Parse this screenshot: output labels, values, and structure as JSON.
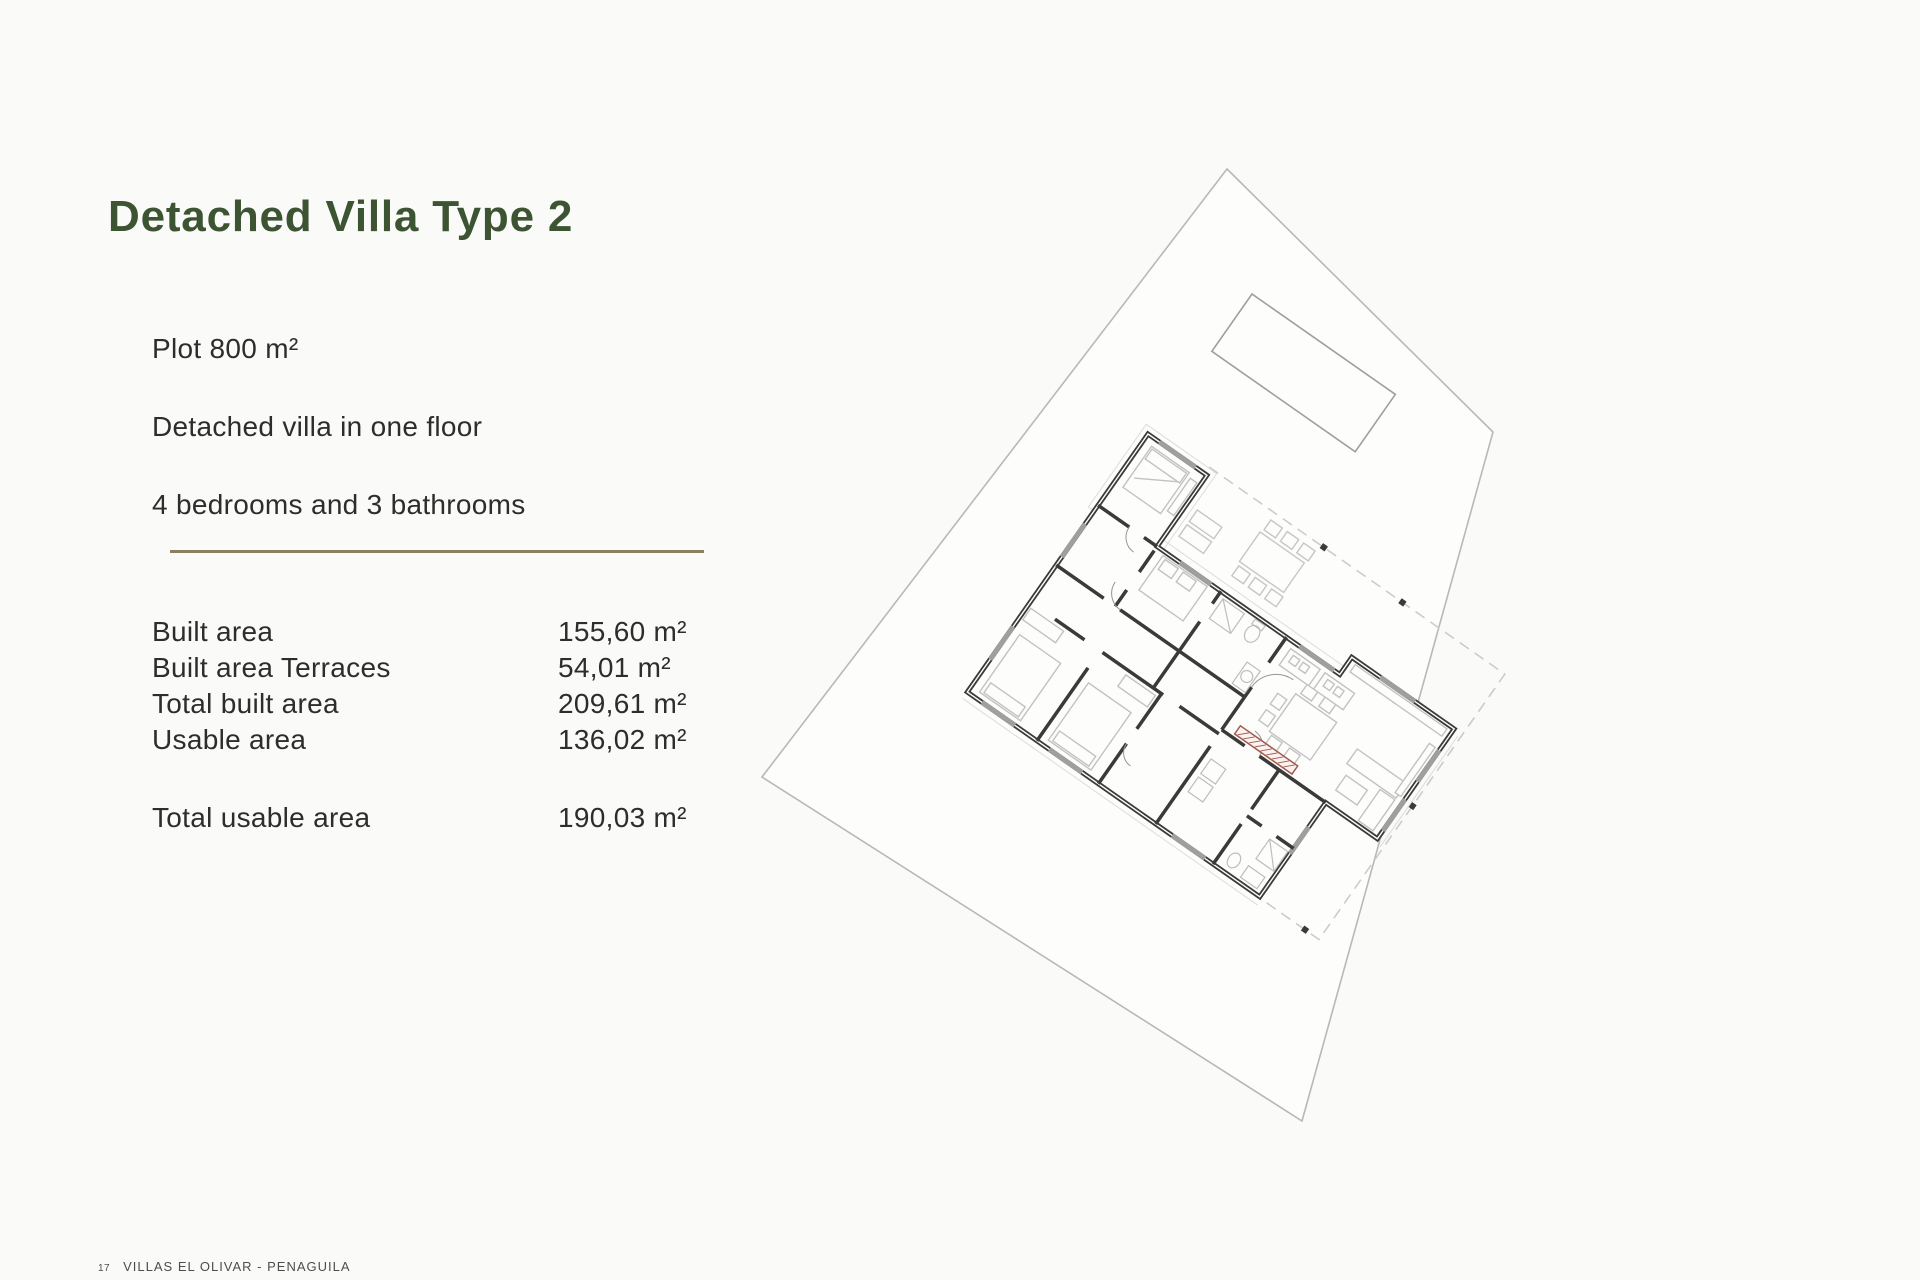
{
  "page": {
    "title": "Detached Villa Type 2",
    "background_color": "#fafaf9",
    "title_color": "#3d5433",
    "divider_color": "#8a8163",
    "plan_accent_color": "#a05a50"
  },
  "specs": [
    "Plot 800 m²",
    "Detached villa in one floor",
    "4 bedrooms and 3 bathrooms"
  ],
  "areas": {
    "rows": [
      {
        "label": "Built area",
        "value": "155,60 m²"
      },
      {
        "label": "Built area Terraces",
        "value": "54,01 m²"
      },
      {
        "label": "Total built area",
        "value": "209,61 m²"
      },
      {
        "label": "Usable area",
        "value": "136,02 m²"
      }
    ],
    "total": {
      "label": "Total usable area",
      "value": "190,03 m²"
    }
  },
  "footer": {
    "page_number": "17",
    "project": "VILLAS EL OLIVAR - PENAGUILA"
  }
}
